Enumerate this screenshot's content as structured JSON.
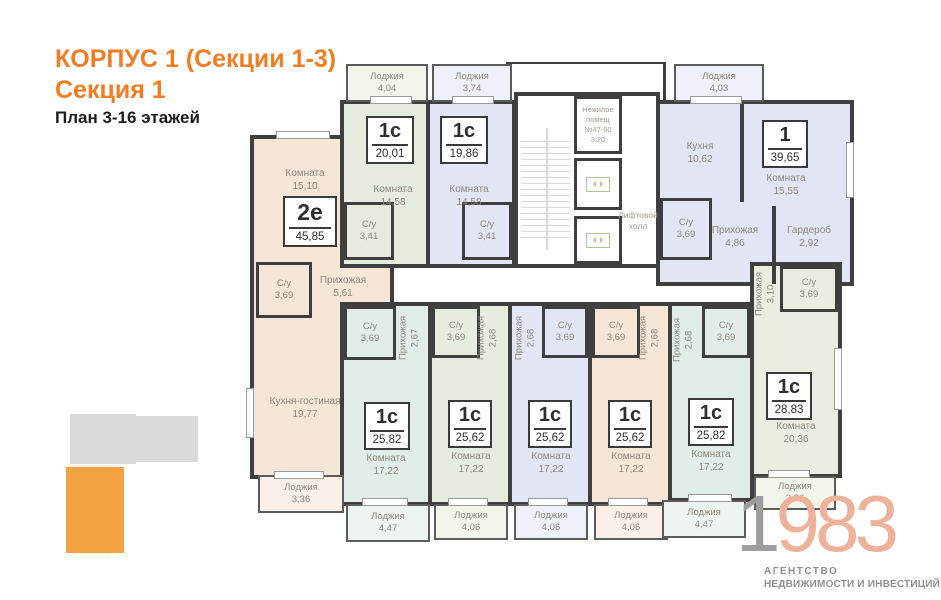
{
  "header": {
    "title_line1": "КОРПУС 1 (Секции 1-3)",
    "title_line2": "Секция 1",
    "subtitle": "План 3-16 этажей"
  },
  "core": {
    "nonresidential": {
      "line1": "Нежилое",
      "line2": "помещ",
      "line3": "№47-60",
      "line4": "3,20"
    },
    "elevator_hall": {
      "line1": "Лифтовой",
      "line2": "холл"
    }
  },
  "apartments": {
    "a1": {
      "type": "2е",
      "area": "45,85",
      "room_name": "Комната",
      "room_area": "15,10",
      "bath_name": "С/у",
      "bath_area": "3,69",
      "hall_name": "Прихожая",
      "hall_area": "5,61",
      "kitchen_name": "Кухня-гостиная",
      "kitchen_area": "19,77",
      "loggia_name": "Лоджия",
      "loggia_area": "3,36"
    },
    "a2": {
      "type": "1с",
      "area": "20,01",
      "room_name": "Комната",
      "room_area": "14,58",
      "bath_name": "С/у",
      "bath_area": "3,41",
      "loggia_name": "Лоджия",
      "loggia_area": "4,04"
    },
    "a3": {
      "type": "1с",
      "area": "19,86",
      "room_name": "Комната",
      "room_area": "14,58",
      "bath_name": "С/у",
      "bath_area": "3,41",
      "loggia_name": "Лоджия",
      "loggia_area": "3,74"
    },
    "a4": {
      "type": "1",
      "area": "39,65",
      "kitchen_name": "Кухня",
      "kitchen_area": "10,62",
      "room_name": "Комната",
      "room_area": "15,55",
      "bath_name": "С/у",
      "bath_area": "3,69",
      "hall_name": "Прихожая",
      "hall_area": "4,86",
      "wardrobe_name": "Гардероб",
      "wardrobe_area": "2,92",
      "loggia_name": "Лоджия",
      "loggia_area": "4,03"
    },
    "b1": {
      "type": "1с",
      "area": "25,82",
      "bath_name": "С/у",
      "bath_area": "3,69",
      "hall_name": "Прихожая",
      "hall_area": "2,67",
      "room_name": "Комната",
      "room_area": "17,22",
      "loggia_name": "Лоджия",
      "loggia_area": "4,47"
    },
    "b2": {
      "type": "1с",
      "area": "25,62",
      "bath_name": "С/у",
      "bath_area": "3,69",
      "hall_name": "Прихожая",
      "hall_area": "2,68",
      "room_name": "Комната",
      "room_area": "17,22",
      "loggia_name": "Лоджия",
      "loggia_area": "4,06"
    },
    "b3": {
      "type": "1с",
      "area": "25,62",
      "bath_name": "С/у",
      "bath_area": "3,69",
      "hall_name": "Прихожая",
      "hall_area": "2,68",
      "room_name": "Комната",
      "room_area": "17,22",
      "loggia_name": "Лоджия",
      "loggia_area": "4,06"
    },
    "b4": {
      "type": "1с",
      "area": "25,62",
      "bath_name": "С/у",
      "bath_area": "3,69",
      "hall_name": "Прихожая",
      "hall_area": "2,68",
      "room_name": "Комната",
      "room_area": "17,22",
      "loggia_name": "Лоджия",
      "loggia_area": "4,06"
    },
    "b5": {
      "type": "1с",
      "area": "25,82",
      "bath_name": "С/у",
      "bath_area": "3,69",
      "hall_name": "Прихожая",
      "hall_area": "2,68",
      "room_name": "Комната",
      "room_area": "17,22",
      "loggia_name": "Лоджия",
      "loggia_area": "4,47"
    },
    "a5": {
      "type": "1с",
      "area": "28,83",
      "hall_name": "Прихожая",
      "hall_area": "3,10",
      "bath_name": "С/у",
      "bath_area": "3,69",
      "room_name": "Комната",
      "room_area": "20,36",
      "loggia_name": "Лоджия",
      "loggia_area": "3,36"
    }
  },
  "logo": {
    "digit_gray": "1",
    "digits_salmon": "983",
    "tagline1": "АГЕНТСТВО",
    "tagline2": "НЕДВИЖИМОСТИ И ИНВЕСТИЦИЙ"
  },
  "palette": {
    "accent_orange": "#ee7d24",
    "wall": "#3f3f3f",
    "apartment_beige": "#f6e6d8",
    "apartment_green": "#e7edde",
    "apartment_lavender": "#e2e6f4",
    "apartment_teal": "#e2ede9",
    "logo_salmon": "#edb29a",
    "logo_gray": "#9d9d9d",
    "keyplan_orange": "#f0a340",
    "keyplan_gray": "#d9d9d9"
  }
}
